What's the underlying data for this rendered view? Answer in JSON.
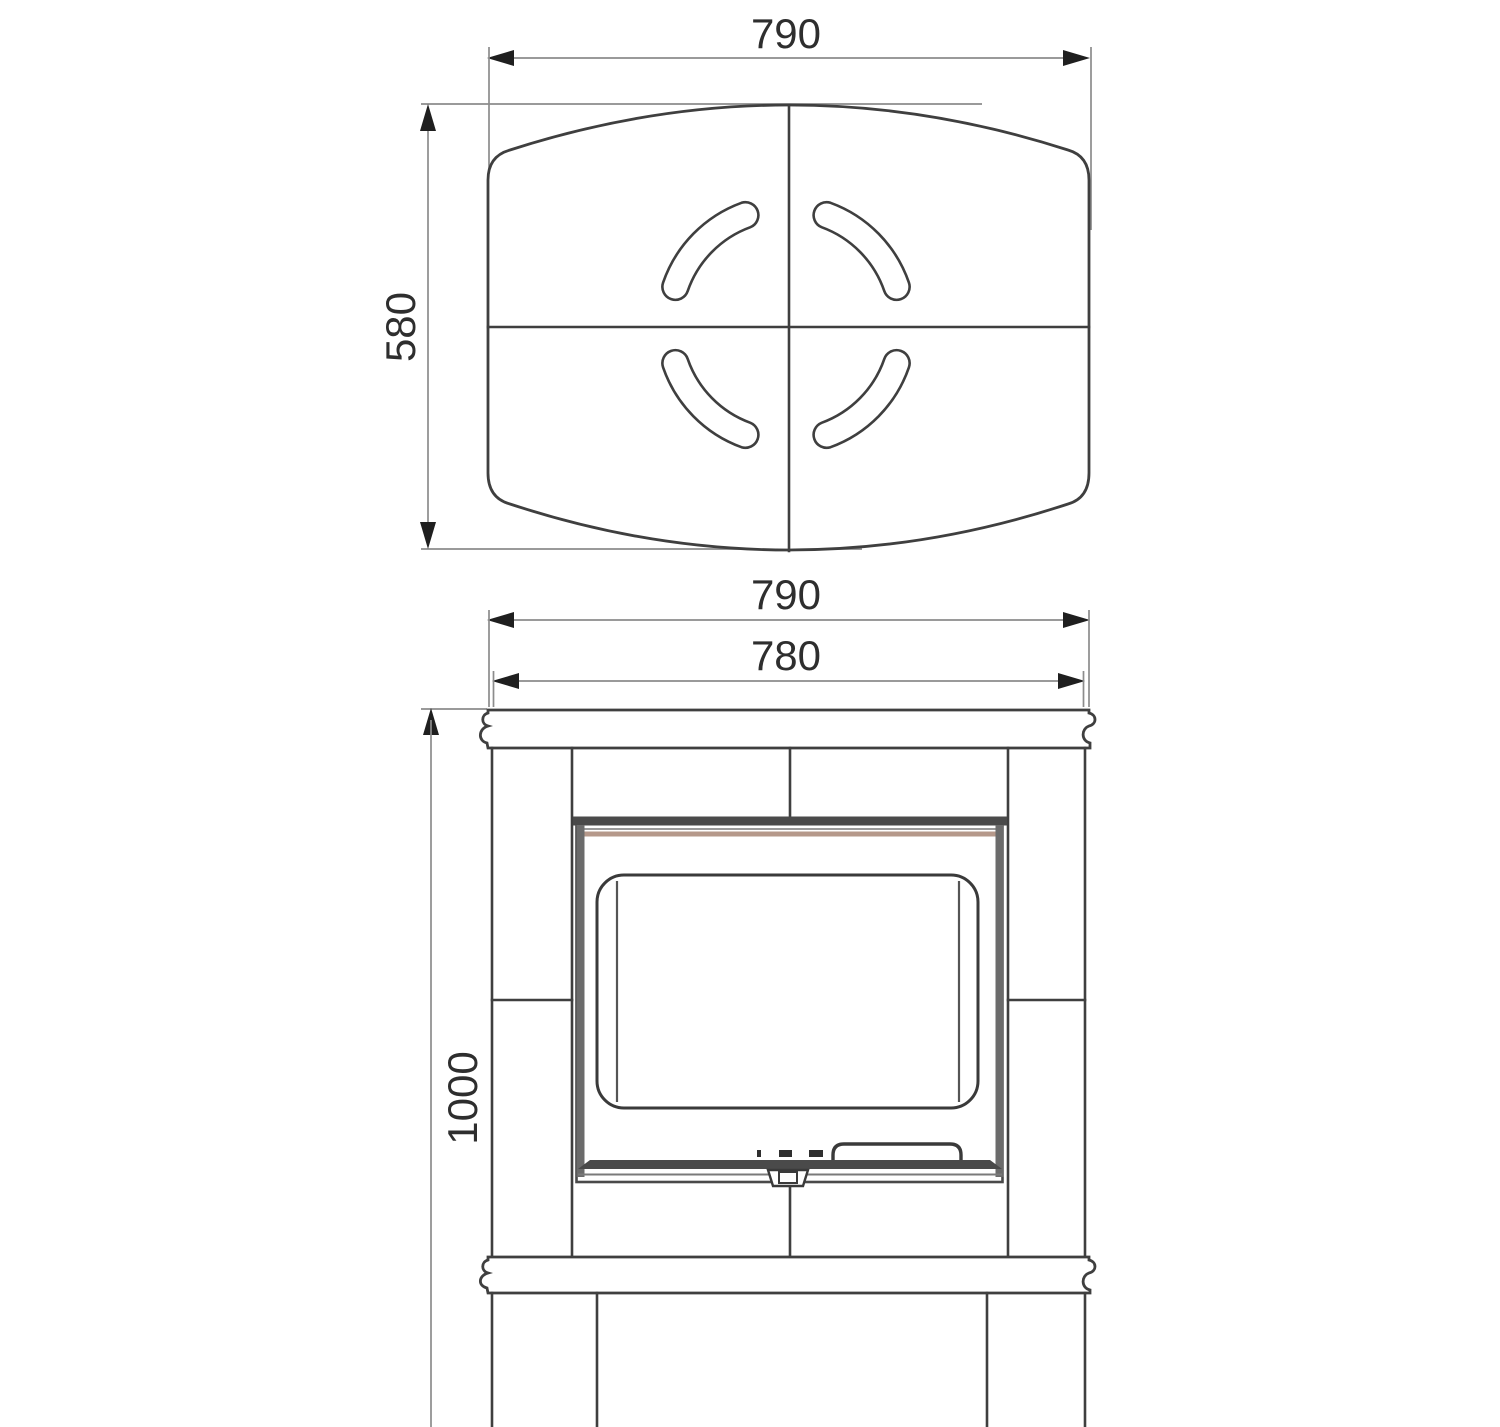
{
  "drawing": {
    "type": "technical-dimension-drawing",
    "subject": "tiled stove / fireplace, top view and front view",
    "top_view": {
      "width": "790",
      "depth": "580"
    },
    "front_view": {
      "top_plate_width": "790",
      "body_width": "780",
      "height": "1000"
    }
  },
  "colors": {
    "background": "#ffffff",
    "outline": "#3f3f3f",
    "dim_line": "#8c8c8c",
    "arrow": "#1f1f1f",
    "text": "#2e2e2e",
    "frame_dark": "#4a4a4a",
    "frame_mid": "#6b6b6b",
    "accent_stripe": "#b5988a"
  }
}
